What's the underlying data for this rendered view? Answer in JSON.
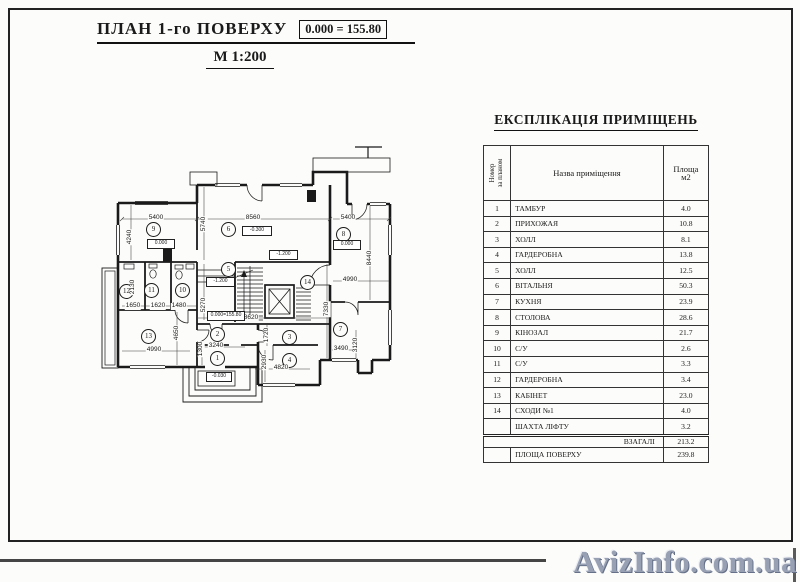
{
  "header": {
    "title": "ПЛАН 1-го ПОВЕРХУ",
    "elevation": "0.000 = 155.80",
    "scale": "М 1:200"
  },
  "watermark": "AvizInfo.com.ua",
  "plan": {
    "rooms": [
      "1",
      "2",
      "3",
      "4",
      "5",
      "6",
      "7",
      "8",
      "9",
      "10",
      "11",
      "12",
      "13",
      "14"
    ],
    "dims_h": [
      "5400",
      "8560",
      "5400",
      "1650",
      "1620",
      "1480",
      "8620",
      "4990",
      "3240",
      "4820",
      "3490",
      "4990"
    ],
    "dims_v": [
      "4240",
      "5740",
      "8440",
      "2130",
      "5270",
      "4650",
      "7330",
      "1720",
      "1300",
      "2930",
      "3120"
    ],
    "marks": [
      "0.000",
      "-0.300",
      "0.000",
      "-1.200",
      "-1.200",
      "0.000=155.80",
      "-0.030"
    ]
  },
  "table": {
    "title": "ЕКСПЛІКАЦІЯ ПРИМІЩЕНЬ",
    "col_num": "Номер\nза планом",
    "col_name": "Назва приміщення",
    "col_area": "Площа\nм2",
    "rows": [
      {
        "n": "1",
        "name": "ТАМБУР",
        "area": "4.0"
      },
      {
        "n": "2",
        "name": "ПРИХОЖАЯ",
        "area": "10.8"
      },
      {
        "n": "3",
        "name": "ХОЛЛ",
        "area": "8.1"
      },
      {
        "n": "4",
        "name": "ГАРДЕРОБНА",
        "area": "13.8"
      },
      {
        "n": "5",
        "name": "ХОЛЛ",
        "area": "12.5"
      },
      {
        "n": "6",
        "name": "ВІТАЛЬНЯ",
        "area": "50.3"
      },
      {
        "n": "7",
        "name": "КУХНЯ",
        "area": "23.9"
      },
      {
        "n": "8",
        "name": "СТОЛОВА",
        "area": "28.6"
      },
      {
        "n": "9",
        "name": "КІНОЗАЛ",
        "area": "21.7"
      },
      {
        "n": "10",
        "name": "С/У",
        "area": "2.6"
      },
      {
        "n": "11",
        "name": "С/У",
        "area": "3.3"
      },
      {
        "n": "12",
        "name": "ГАРДЕРОБНА",
        "area": "3.4"
      },
      {
        "n": "13",
        "name": "КАБІНЕТ",
        "area": "23.0"
      },
      {
        "n": "14",
        "name": "СХОДИ №1",
        "area": "4.0"
      },
      {
        "n": "",
        "name": "ШАХТА ЛІФТУ",
        "area": "3.2"
      }
    ],
    "total_label": "ВЗАГАЛІ",
    "total_area": "213.2",
    "floor_label": "ПЛОЩА ПОВЕРХУ",
    "floor_area": "239.8"
  }
}
